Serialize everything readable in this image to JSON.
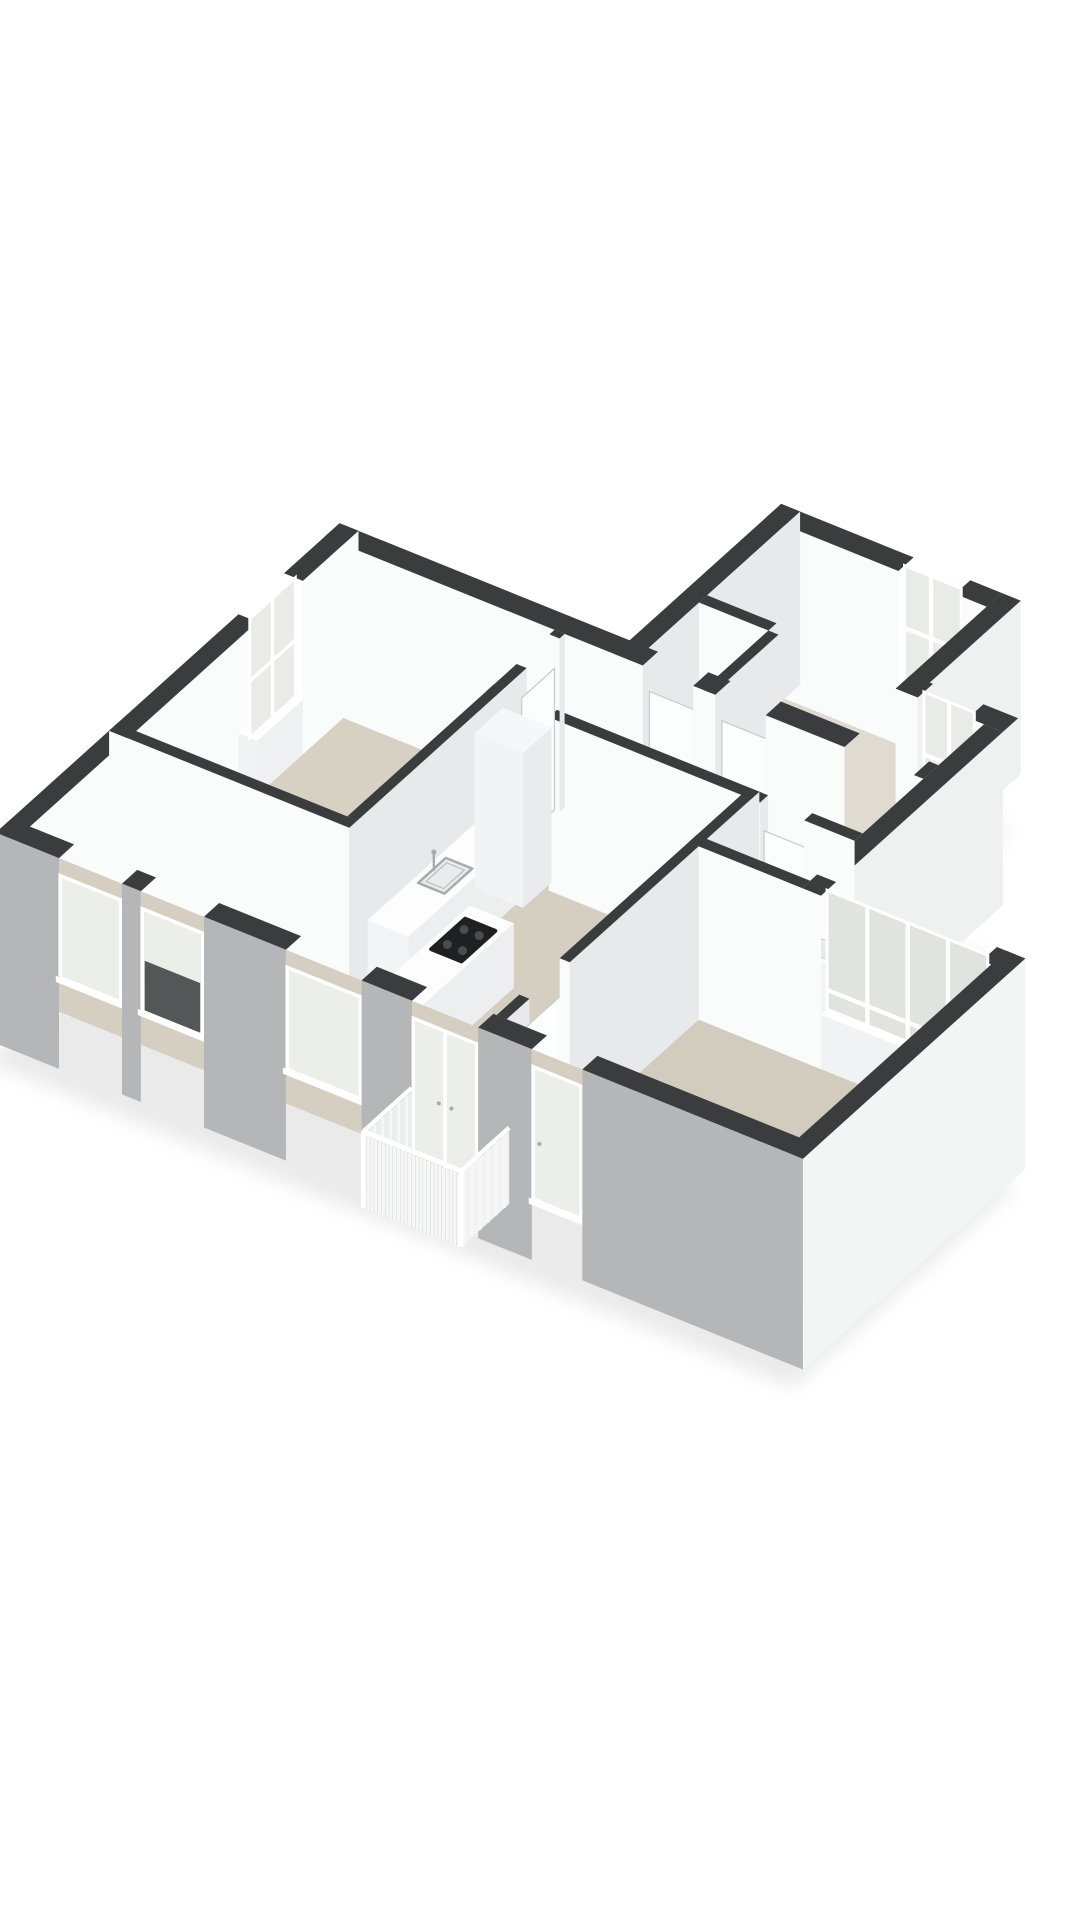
{
  "scene": {
    "kind": "3d-floorplan-axonometric-render",
    "background": "#ffffff",
    "canvas": {
      "width": 1080,
      "height": 1920
    }
  },
  "palette": {
    "wall_top": "#3b3c3e",
    "wall_face_bright": "#fafbfb",
    "wall_face_shaded": "#e7e9ea",
    "facade_gray": "#b5b6b8",
    "facade_white": "#f3f4f4",
    "exterior_light": "#eff0f0",
    "glass_cut": "#e9ebe7",
    "glass_out": "#eceeea",
    "glass_band": "#e0e3de",
    "glass_dark": "#3a3c3e",
    "frame_white": "#ffffff",
    "floor_living": "#d5cfc2",
    "floor_bed_left": "#d7d1c4",
    "floor_bed_right": "#d2ccbf",
    "floor_corridor": "#dbd6ca",
    "floor_bathroom": "#dad5c8",
    "floor_annex": "#e0dbd0",
    "balcony_floor": "#e9e9e7",
    "railing_back": "#d6d8d7",
    "slat_white": "#f6f7f6",
    "fixture_white_top": "#fdfdfd",
    "fixture_white_south": "#f3f4f5",
    "fixture_white_east": "#eceeef",
    "cooktop_black": "#1e2022",
    "burner_gray": "#4a4d4f",
    "steel": "#a6abae",
    "pipe_black": "#232426",
    "pipe_red": "#8b3e2f",
    "shadow": "#d2d2d2",
    "leaf_fill": "#fcfdfd",
    "leaf_edge": "#c9cbcc"
  },
  "projection": {
    "origin": [
      30,
      1000
    ],
    "scale": 68,
    "angle_v_deg": 22,
    "angle_u_deg": 42,
    "wall_height": 2.55
  },
  "legend": {
    "cooktop_burners": 4,
    "vanity_faucets": 2,
    "utility_pipes_black": 3,
    "utility_pipes_red": 1,
    "window_band_panes": 4,
    "balcony_slats": 26,
    "kitchen_facade_windows": 2
  },
  "shadow": {
    "poly": [
      [
        -0.3,
        -0.3
      ],
      [
        -0.3,
        6.5
      ],
      [
        4.3,
        6.5
      ],
      [
        4.3,
        9.5
      ],
      [
        8.1,
        9.5
      ],
      [
        8.1,
        7.4
      ],
      [
        9.5,
        7.4
      ],
      [
        9.5,
        4.1
      ],
      [
        12.5,
        4.1
      ],
      [
        12.5,
        -0.3
      ]
    ],
    "z": -0.55,
    "offset": [
      -10,
      18
    ],
    "blur": 9,
    "opacity": 0.45
  },
  "floors": [
    {
      "name": "floor-annex-room",
      "poly": [
        [
          4.6,
          6.2
        ],
        [
          4.6,
          9.2
        ],
        [
          7.8,
          9.2
        ],
        [
          7.8,
          7.4
        ],
        [
          9.2,
          7.4
        ],
        [
          9.2,
          6.2
        ]
      ],
      "color": "#e0dbd0"
    },
    {
      "name": "floor-corridor",
      "poly": [
        [
          3.35,
          5.0
        ],
        [
          3.35,
          6.2
        ],
        [
          9.2,
          6.2
        ],
        [
          9.2,
          5.0
        ]
      ],
      "color": "#dbd6ca"
    },
    {
      "name": "floor-bathroom",
      "poly": [
        [
          7.4,
          3.8
        ],
        [
          7.4,
          5.0
        ],
        [
          9.2,
          5.0
        ],
        [
          9.2,
          3.8
        ]
      ],
      "color": "#dad5c8"
    },
    {
      "name": "floor-bedroom-left",
      "poly": [
        [
          0,
          2.1
        ],
        [
          0,
          6.2
        ],
        [
          3.35,
          6.2
        ],
        [
          3.35,
          2.1
        ]
      ],
      "color": "#d7d1c4"
    },
    {
      "name": "floor-living-kitchen",
      "poly": [
        [
          0,
          0
        ],
        [
          0,
          2.1
        ],
        [
          3.35,
          2.1
        ],
        [
          3.35,
          5.0
        ],
        [
          7.4,
          5.0
        ],
        [
          7.4,
          0
        ]
      ],
      "color": "#d5cfc2"
    },
    {
      "name": "floor-bedroom-right",
      "poly": [
        [
          7.4,
          0
        ],
        [
          7.4,
          3.8
        ],
        [
          12.2,
          3.8
        ],
        [
          12.2,
          0
        ]
      ],
      "color": "#d2ccbf"
    }
  ],
  "elements": [
    {
      "kind": "box",
      "name": "annex-north-wall-a",
      "r": [
        4.3,
        6.4,
        9.2,
        9.5
      ],
      "z": [
        0,
        2.55
      ],
      "c": {
        "s": "#fafbfb",
        "t": "#3b3c3e"
      }
    },
    {
      "kind": "box",
      "name": "annex-north-wall-b",
      "r": [
        7.3,
        7.8,
        9.2,
        9.5
      ],
      "z": [
        0,
        2.55
      ],
      "c": {
        "s": "#fafbfb",
        "t": "#3b3c3e"
      }
    },
    {
      "kind": "cutWindow",
      "name": "annex-window",
      "orient": "alongV",
      "plane": 9.32,
      "span": [
        6.4,
        7.3
      ],
      "z": [
        0.8,
        2.55
      ],
      "sill": [
        6.4,
        7.3,
        9.2,
        9.5
      ],
      "mullions": [
        6.82
      ],
      "rail": 1.6,
      "glass": "#e9ebe7"
    },
    {
      "kind": "box",
      "name": "annex-west-wall",
      "r": [
        4.3,
        4.6,
        6.2,
        9.5
      ],
      "z": [
        0,
        2.55
      ],
      "c": {
        "e": "#e7e9ea",
        "t": "#3b3c3e"
      }
    },
    {
      "kind": "box",
      "name": "annex-east-wall",
      "r": [
        7.8,
        8.1,
        7.4,
        9.5
      ],
      "z": [
        0,
        2.55
      ],
      "c": {
        "e": "#eff0f0",
        "s": "#fafbfb",
        "t": "#3b3c3e"
      }
    },
    {
      "kind": "box",
      "name": "closet-north-wall",
      "r": [
        4.6,
        5.7,
        7.5,
        7.66
      ],
      "z": [
        0,
        2.55
      ],
      "c": {
        "s": "#fafbfb",
        "t": "#3b3c3e"
      }
    },
    {
      "kind": "pipes",
      "name": "utility-pipes",
      "u": 7.42,
      "h": 1.6,
      "items": [
        {
          "v": 4.78,
          "color": "#232426"
        },
        {
          "v": 4.93,
          "color": "#232426"
        },
        {
          "v": 5.08,
          "color": "#232426"
        },
        {
          "v": 5.38,
          "color": "#8b3e2f"
        }
      ]
    },
    {
      "kind": "box",
      "name": "closet-east-wall",
      "r": [
        5.7,
        5.86,
        6.2,
        7.5
      ],
      "z": [
        0,
        2.55
      ],
      "c": {
        "e": "#e7e9ea",
        "s": "#fafbfb",
        "t": "#3b3c3e"
      }
    },
    {
      "kind": "box",
      "name": "bay-north-wall-a",
      "r": [
        7.8,
        8.15,
        7.4,
        7.7
      ],
      "z": [
        0,
        2.55
      ],
      "c": {
        "s": "#fafbfb",
        "t": "#3b3c3e"
      }
    },
    {
      "kind": "box",
      "name": "bay-north-wall-b",
      "r": [
        8.95,
        9.5,
        7.4,
        7.7
      ],
      "z": [
        0,
        2.55
      ],
      "c": {
        "s": "#fafbfb",
        "t": "#3b3c3e"
      }
    },
    {
      "kind": "cutWindow",
      "name": "bay-window",
      "orient": "alongV",
      "plane": 7.52,
      "span": [
        8.15,
        8.95
      ],
      "z": [
        0.8,
        2.55
      ],
      "sill": [
        8.15,
        8.95,
        7.4,
        7.7
      ],
      "mullions": [
        8.55
      ],
      "rail": 1.6,
      "glass": "#e9ebe7"
    },
    {
      "kind": "box",
      "name": "north-wall-a",
      "r": [
        -0.3,
        4.75,
        6.2,
        6.5
      ],
      "z": [
        0,
        2.55
      ],
      "c": {
        "s": "#fafbfb",
        "t": "#3b3c3e"
      }
    },
    {
      "kind": "doorLeaf",
      "name": "closet-door",
      "orient": "alongV",
      "plane": 6.33,
      "span": [
        4.75,
        5.55
      ]
    },
    {
      "kind": "box",
      "name": "north-wall-b",
      "r": [
        5.55,
        5.9,
        6.2,
        6.5
      ],
      "z": [
        0,
        2.55
      ],
      "c": {
        "s": "#fafbfb",
        "t": "#3b3c3e"
      }
    },
    {
      "kind": "doorLeaf",
      "name": "annex-door",
      "orient": "alongV",
      "plane": 6.33,
      "span": [
        5.9,
        6.7
      ]
    },
    {
      "kind": "box",
      "name": "north-wall-c",
      "r": [
        6.7,
        7.95,
        6.2,
        6.5
      ],
      "z": [
        0,
        2.55
      ],
      "c": {
        "s": "#fafbfb",
        "t": "#3b3c3e"
      }
    },
    {
      "kind": "box",
      "name": "north-wall-d",
      "r": [
        9.05,
        9.2,
        6.2,
        6.5
      ],
      "z": [
        0,
        2.55
      ],
      "c": {
        "s": "#fafbfb",
        "t": "#3b3c3e"
      }
    },
    {
      "kind": "box",
      "name": "east-upper-wall",
      "r": [
        9.2,
        9.5,
        3.8,
        7.4
      ],
      "z": [
        0,
        2.55
      ],
      "c": {
        "e": "#eff0f0",
        "s": "#fafbfb",
        "t": "#3b3c3e"
      }
    },
    {
      "kind": "box",
      "name": "west-facade-a",
      "r": [
        -0.3,
        0,
        -0.3,
        4.5
      ],
      "z": [
        0,
        2.55
      ],
      "c": {
        "e": "#fafbfb",
        "t": "#3b3c3e"
      }
    },
    {
      "kind": "box",
      "name": "west-facade-b",
      "r": [
        -0.3,
        0,
        5.4,
        6.5
      ],
      "z": [
        0,
        2.55
      ],
      "c": {
        "e": "#fafbfb",
        "t": "#3b3c3e"
      }
    },
    {
      "kind": "cutWindow",
      "name": "bedroom-left-window",
      "orient": "alongU",
      "plane": -0.12,
      "span": [
        4.5,
        5.4
      ],
      "z": [
        0.8,
        2.55
      ],
      "sill": [
        -0.3,
        0,
        4.5,
        5.4
      ],
      "mullions": [
        4.95
      ],
      "rail": 1.6,
      "glass": "#e9ebe7"
    },
    {
      "kind": "box",
      "name": "corridor-south-wall-a",
      "r": [
        3.35,
        3.5,
        4.84,
        5.0
      ],
      "z": [
        0,
        2.55
      ],
      "c": {
        "s": "#fafbfb",
        "e": "#e7e9ea",
        "t": "#3b3c3e"
      }
    },
    {
      "kind": "box",
      "name": "corridor-south-wall-b",
      "r": [
        4.35,
        7.7,
        4.84,
        5.0
      ],
      "z": [
        0,
        2.55
      ],
      "c": {
        "s": "#fafbfb",
        "e": "#e7e9ea",
        "t": "#3b3c3e"
      }
    },
    {
      "kind": "doorLeaf",
      "name": "bathroom-door",
      "orient": "alongV",
      "plane": 4.92,
      "span": [
        7.7,
        8.4
      ]
    },
    {
      "kind": "box",
      "name": "corridor-south-wall-c",
      "r": [
        8.4,
        9.2,
        4.84,
        5.0
      ],
      "z": [
        0,
        2.55
      ],
      "c": {
        "s": "#fafbfb",
        "t": "#3b3c3e"
      }
    },
    {
      "kind": "box",
      "name": "bathroom-west-wall",
      "r": [
        7.4,
        7.56,
        3.8,
        5.0
      ],
      "z": [
        0,
        2.55
      ],
      "c": {
        "e": "#e7e9ea",
        "s": "#fafbfb",
        "t": "#3b3c3e"
      }
    },
    {
      "kind": "box",
      "name": "bathroom-vanity",
      "r": [
        7.56,
        7.98,
        3.98,
        4.88
      ],
      "z": [
        0,
        0.85
      ],
      "c": {
        "t": "#fdfdfd",
        "s": "#f3f4f5",
        "e": "#eceeef"
      }
    },
    {
      "kind": "faucet",
      "name": "vanity-faucet-1",
      "v": 7.7,
      "u": 4.2,
      "z": 0.85
    },
    {
      "kind": "faucet",
      "name": "vanity-faucet-2",
      "v": 7.7,
      "u": 4.62,
      "z": 0.85
    },
    {
      "kind": "basin",
      "name": "bathroom-washbasin",
      "r": [
        8.55,
        9.05,
        4.5,
        4.92
      ],
      "z": [
        0,
        0.9
      ]
    },
    {
      "kind": "box",
      "name": "bedroom-left-east-wall-a",
      "r": [
        3.35,
        3.51,
        2.1,
        5.45
      ],
      "z": [
        0,
        2.55
      ],
      "c": {
        "e": "#e7e9ea",
        "t": "#3b3c3e"
      }
    },
    {
      "kind": "doorLeaf",
      "name": "bedroom-left-door",
      "orient": "alongU",
      "plane": 3.43,
      "span": [
        5.45,
        6.1
      ]
    },
    {
      "kind": "box",
      "name": "bedroom-left-east-wall-b",
      "r": [
        3.35,
        3.51,
        6.1,
        6.2
      ],
      "z": [
        0,
        2.55
      ],
      "c": {
        "e": "#e7e9ea",
        "t": "#3b3c3e"
      }
    },
    {
      "kind": "box",
      "name": "bedroom-left-south-wall",
      "r": [
        -0.3,
        3.51,
        1.94,
        2.1
      ],
      "z": [
        0,
        2.55
      ],
      "c": {
        "s": "#fafbfb",
        "e": "#e7e9ea",
        "t": "#3b3c3e"
      }
    },
    {
      "kind": "box",
      "name": "bathroom-south-wall",
      "r": [
        7.4,
        9.2,
        3.8,
        3.96
      ],
      "z": [
        0,
        2.55
      ],
      "c": {
        "s": "#fafbfb",
        "t": "#3b3c3e"
      }
    },
    {
      "kind": "box",
      "name": "band-wall-a",
      "r": [
        9.2,
        9.5,
        3.8,
        4.1
      ],
      "z": [
        0,
        2.55
      ],
      "c": {
        "s": "#fafbfb",
        "t": "#3b3c3e"
      }
    },
    {
      "kind": "box",
      "name": "band-wall-b",
      "r": [
        12.05,
        12.5,
        3.8,
        4.1
      ],
      "z": [
        0,
        2.55
      ],
      "c": {
        "s": "#fafbfb",
        "t": "#3b3c3e"
      }
    },
    {
      "kind": "cutWindow",
      "name": "bedroom-right-window-band",
      "orient": "alongV",
      "plane": 3.92,
      "span": [
        9.5,
        12.05
      ],
      "z": [
        0.8,
        2.55
      ],
      "sill": [
        9.5,
        12.05,
        3.8,
        4.1
      ],
      "mullions": [
        10.14,
        10.78,
        11.42
      ],
      "rail": 1.05,
      "glass": "#e0e3de"
    },
    {
      "kind": "box",
      "name": "kitchen-counter",
      "r": [
        3.51,
        4.16,
        2.3,
        4.95
      ],
      "z": [
        0,
        0.95
      ],
      "c": {
        "t": "#fdfdfd",
        "s": "#f3f4f5",
        "e": "#eceeef"
      }
    },
    {
      "kind": "sink",
      "name": "kitchen-sink",
      "v": 3.82,
      "u": 3.45,
      "z": 0.95,
      "w": 0.42,
      "d": 0.55
    },
    {
      "kind": "faucet",
      "name": "kitchen-faucet",
      "v": 3.64,
      "u": 3.45,
      "z": 0.95
    },
    {
      "kind": "box",
      "name": "kitchen-tall-cabinet",
      "r": [
        3.51,
        4.28,
        4.42,
        4.98
      ],
      "z": [
        0,
        2.28
      ],
      "c": {
        "t": "#f6f7f8",
        "s": "#f2f3f4",
        "e": "#e9ebec"
      }
    },
    {
      "kind": "box",
      "name": "kitchen-island",
      "r": [
        4.45,
        5.15,
        1.35,
        3.15
      ],
      "z": [
        0,
        0.95
      ],
      "c": {
        "t": "#fdfdfe",
        "s": "#f3f4f5",
        "e": "#eceeef"
      }
    },
    {
      "kind": "cooktop",
      "name": "island-cooktop",
      "r": [
        4.56,
        5.04,
        2.25,
        2.92
      ],
      "z": 0.95,
      "burners": [
        [
          4.68,
          2.42
        ],
        [
          4.92,
          2.42
        ],
        [
          4.68,
          2.75
        ],
        [
          4.92,
          2.75
        ]
      ]
    },
    {
      "kind": "box",
      "name": "living-bedroom-divider-a",
      "r": [
        7.4,
        7.56,
        0,
        0.45
      ],
      "z": [
        0,
        2.55
      ],
      "c": {
        "s": "#fafbfb",
        "e": "#e7e9ea",
        "t": "#3b3c3e"
      }
    },
    {
      "kind": "doorLeaf",
      "name": "bedroom-right-door",
      "orient": "alongU",
      "plane": 7.48,
      "span": [
        0.45,
        1.25
      ]
    },
    {
      "kind": "box",
      "name": "living-bedroom-divider-b",
      "r": [
        7.4,
        7.56,
        1.25,
        3.8
      ],
      "z": [
        0,
        2.55
      ],
      "c": {
        "s": "#fafbfb",
        "e": "#e7e9ea",
        "t": "#3b3c3e"
      }
    },
    {
      "kind": "box",
      "name": "east-fascia",
      "r": [
        12.2,
        12.5,
        -0.3,
        4.1
      ],
      "z": [
        -0.55,
        2.55
      ],
      "c": {
        "e": "#f3f4f4",
        "s": "#fafbfb",
        "t": "#3b3c3e"
      }
    },
    {
      "kind": "box",
      "name": "south-facade-a",
      "r": [
        -0.3,
        0.7,
        -0.3,
        0
      ],
      "z": [
        -0.55,
        2.55
      ],
      "c": {
        "s": "#b5b6b8",
        "t": "#3b3c3e"
      }
    },
    {
      "kind": "facadeOpening",
      "name": "kitchen-window-1",
      "span": [
        0.7,
        1.7
      ],
      "sillZ": 0.8,
      "style": "window",
      "dark": false
    },
    {
      "kind": "box",
      "name": "south-facade-b",
      "r": [
        1.7,
        2.0,
        -0.3,
        0
      ],
      "z": [
        -0.55,
        2.55
      ],
      "c": {
        "s": "#b5b6b8",
        "t": "#3b3c3e"
      }
    },
    {
      "kind": "facadeOpening",
      "name": "kitchen-window-2",
      "span": [
        2.0,
        3.0
      ],
      "sillZ": 0.8,
      "style": "window",
      "dark": true
    },
    {
      "kind": "box",
      "name": "south-facade-c",
      "r": [
        3.0,
        4.3,
        -0.3,
        0
      ],
      "z": [
        -0.55,
        2.55
      ],
      "c": {
        "s": "#b5b6b8",
        "t": "#3b3c3e"
      }
    },
    {
      "kind": "facadeOpening",
      "name": "living-window",
      "span": [
        4.3,
        5.5
      ],
      "sillZ": 0.8,
      "style": "window",
      "dark": false
    },
    {
      "kind": "box",
      "name": "south-facade-d",
      "r": [
        5.5,
        6.3,
        -0.3,
        0
      ],
      "z": [
        -0.55,
        2.55
      ],
      "c": {
        "s": "#b5b6b8",
        "t": "#3b3c3e"
      }
    },
    {
      "kind": "facadeOpening",
      "name": "balcony-french-doors",
      "span": [
        6.3,
        7.35
      ],
      "sillZ": 0.0,
      "style": "doors2",
      "dark": false
    },
    {
      "kind": "box",
      "name": "south-facade-e",
      "r": [
        7.35,
        8.2,
        -0.3,
        0
      ],
      "z": [
        -0.55,
        2.55
      ],
      "c": {
        "s": "#b5b6b8",
        "t": "#3b3c3e"
      }
    },
    {
      "kind": "facadeOpening",
      "name": "bedroom-right-window-door",
      "span": [
        8.2,
        9.0
      ],
      "sillZ": 0.35,
      "style": "door1",
      "dark": false
    },
    {
      "kind": "box",
      "name": "south-facade-f",
      "r": [
        9.0,
        12.5,
        -0.3,
        0
      ],
      "z": [
        -0.55,
        2.55
      ],
      "c": {
        "s": "#b5b6b8",
        "t": "#3b3c3e"
      }
    },
    {
      "kind": "balconyFloor",
      "name": "balcony-floor",
      "v": [
        6.05,
        7.6
      ],
      "u": [
        -0.95,
        0
      ],
      "z": -0.06
    },
    {
      "kind": "railing",
      "name": "balcony-railing",
      "v": [
        6.05,
        7.6
      ],
      "uFront": -0.95,
      "z": [
        -0.15,
        0.92
      ],
      "slats": 26,
      "sideSlats": 6
    }
  ]
}
